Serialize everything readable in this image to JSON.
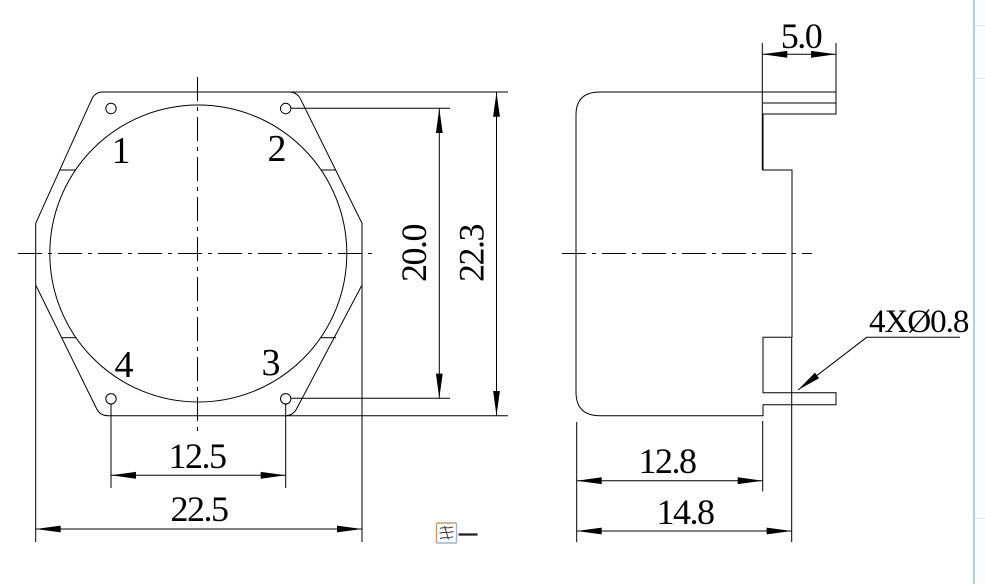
{
  "drawing": {
    "caption": "图一",
    "front_view": {
      "hole_labels": {
        "h1": "1",
        "h2": "2",
        "h3": "3",
        "h4": "4"
      },
      "dims": {
        "hole_span_vertical": {
          "label": "20.0"
        },
        "overall_height": {
          "label": "22.3"
        },
        "hole_span_horizontal": {
          "label": "12.5"
        },
        "overall_width": {
          "label": "22.5"
        }
      }
    },
    "side_view": {
      "dims": {
        "flange_width": {
          "label": "5.0"
        },
        "body_depth": {
          "label": "12.8"
        },
        "overall_depth": {
          "label": "14.8"
        }
      },
      "leader": {
        "label": "4XØ0.8"
      }
    },
    "colors": {
      "line": "#000000",
      "window_edge": "#a7c0da",
      "caption_box_warm": "#cf9a62",
      "caption_box_cool": "#9fb6cc"
    }
  }
}
